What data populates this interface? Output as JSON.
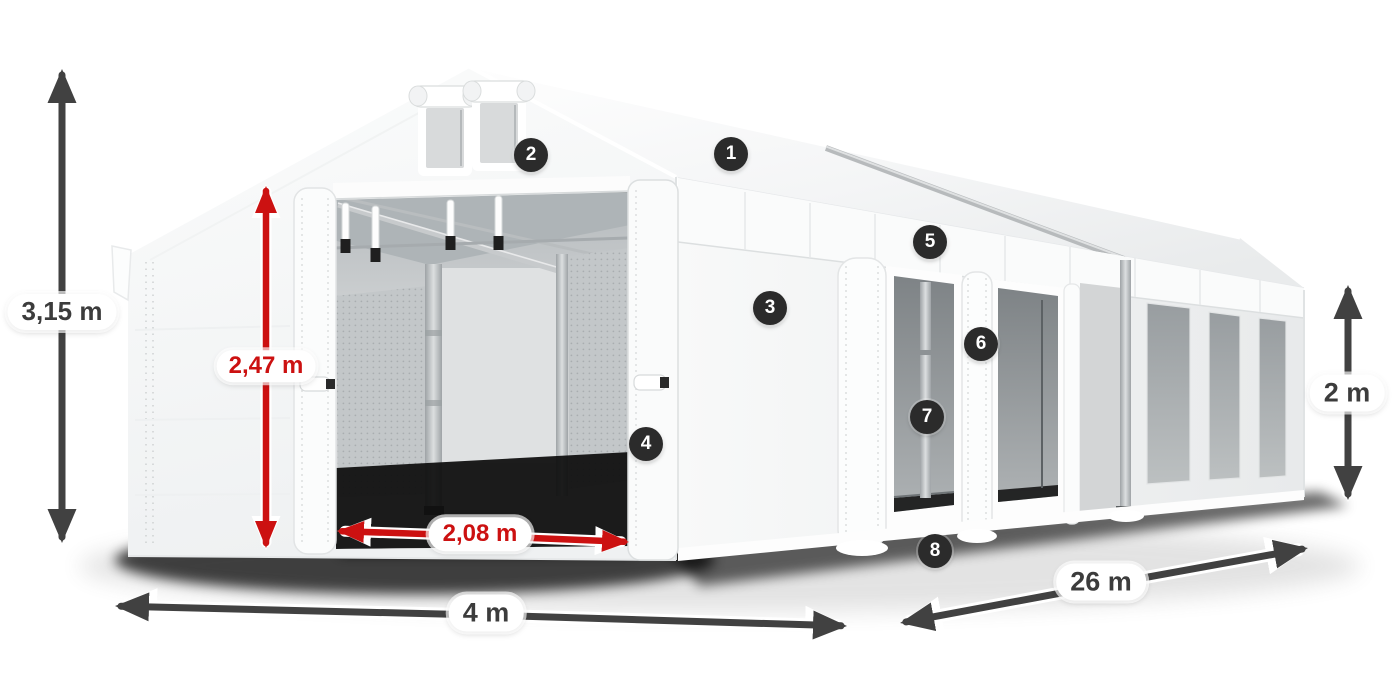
{
  "figure": {
    "type": "product-dimension-diagram",
    "subject": "White marquee party tent, front-left perspective view, open front entrance and open side sections"
  },
  "dimensions": [
    {
      "id": "total-height",
      "label": "3,15 m",
      "color": "dark",
      "orientation": "vertical",
      "measures": "overall tent height at gable"
    },
    {
      "id": "entrance-height",
      "label": "2,47 m",
      "color": "red",
      "orientation": "vertical",
      "measures": "entrance clearance height"
    },
    {
      "id": "entrance-width",
      "label": "2,08 m",
      "color": "red",
      "orientation": "horizontal",
      "measures": "entrance clearance width"
    },
    {
      "id": "tent-width",
      "label": "4 m",
      "color": "dark",
      "orientation": "horizontal",
      "measures": "tent gable width"
    },
    {
      "id": "tent-length",
      "label": "26 m",
      "color": "dark",
      "orientation": "diagonal",
      "measures": "tent side length"
    },
    {
      "id": "side-height",
      "label": "2 m",
      "color": "dark",
      "orientation": "vertical",
      "measures": "side wall height"
    }
  ],
  "callouts": [
    {
      "number": "1"
    },
    {
      "number": "2"
    },
    {
      "number": "3"
    },
    {
      "number": "4"
    },
    {
      "number": "5"
    },
    {
      "number": "6"
    },
    {
      "number": "7"
    },
    {
      "number": "8"
    }
  ],
  "colors": {
    "dimension_red": "#cc1111",
    "dimension_dark": "#414141",
    "badge_bg": "#2b2b2b",
    "badge_fg": "#ffffff",
    "pill_bg": "#ffffff",
    "pill_dark_text": "#3c3c3c",
    "background": "#ffffff"
  }
}
